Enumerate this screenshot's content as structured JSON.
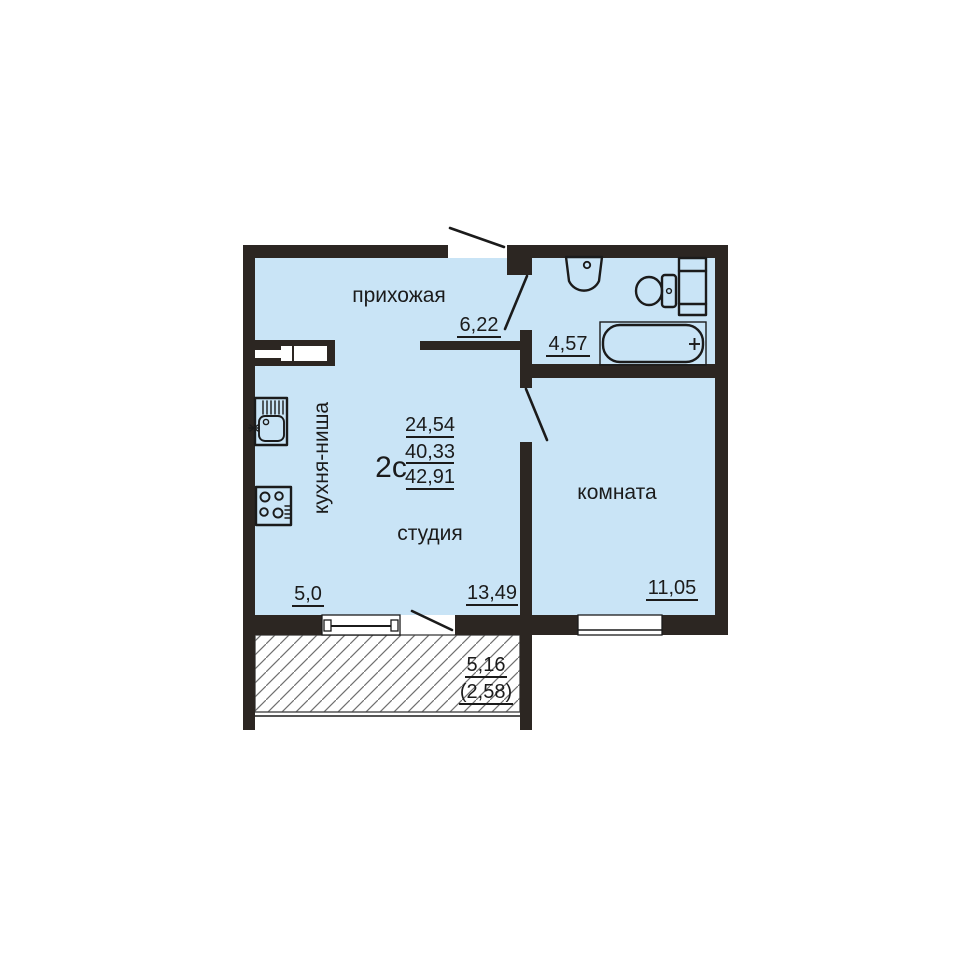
{
  "colors": {
    "floor": "#c9e4f6",
    "wall": "#2c2622",
    "line": "#1b1b1b",
    "background": "#ffffff"
  },
  "plan": {
    "apartment_type": "2с",
    "area_living": "24,54",
    "area_total": "40,33",
    "area_total_with_balcony": "42,91"
  },
  "rooms": {
    "hallway": {
      "label": "прихожая",
      "area": "6,22"
    },
    "bathroom": {
      "area": "4,57"
    },
    "kitchen_niche": {
      "label": "кухня-ниша",
      "area": "5,0"
    },
    "studio": {
      "label": "студия",
      "area": "13,49"
    },
    "room": {
      "label": "комната",
      "area": "11,05"
    },
    "balcony": {
      "area": "5,16",
      "area_with_coefficient": "(2,58)"
    }
  },
  "fixtures": [
    "bathroom-sink",
    "toilet",
    "plumbing-shaft",
    "bathtub",
    "kitchen-sink",
    "stove",
    "ventilation-duct",
    "entrance-door",
    "balcony-door",
    "windows"
  ]
}
